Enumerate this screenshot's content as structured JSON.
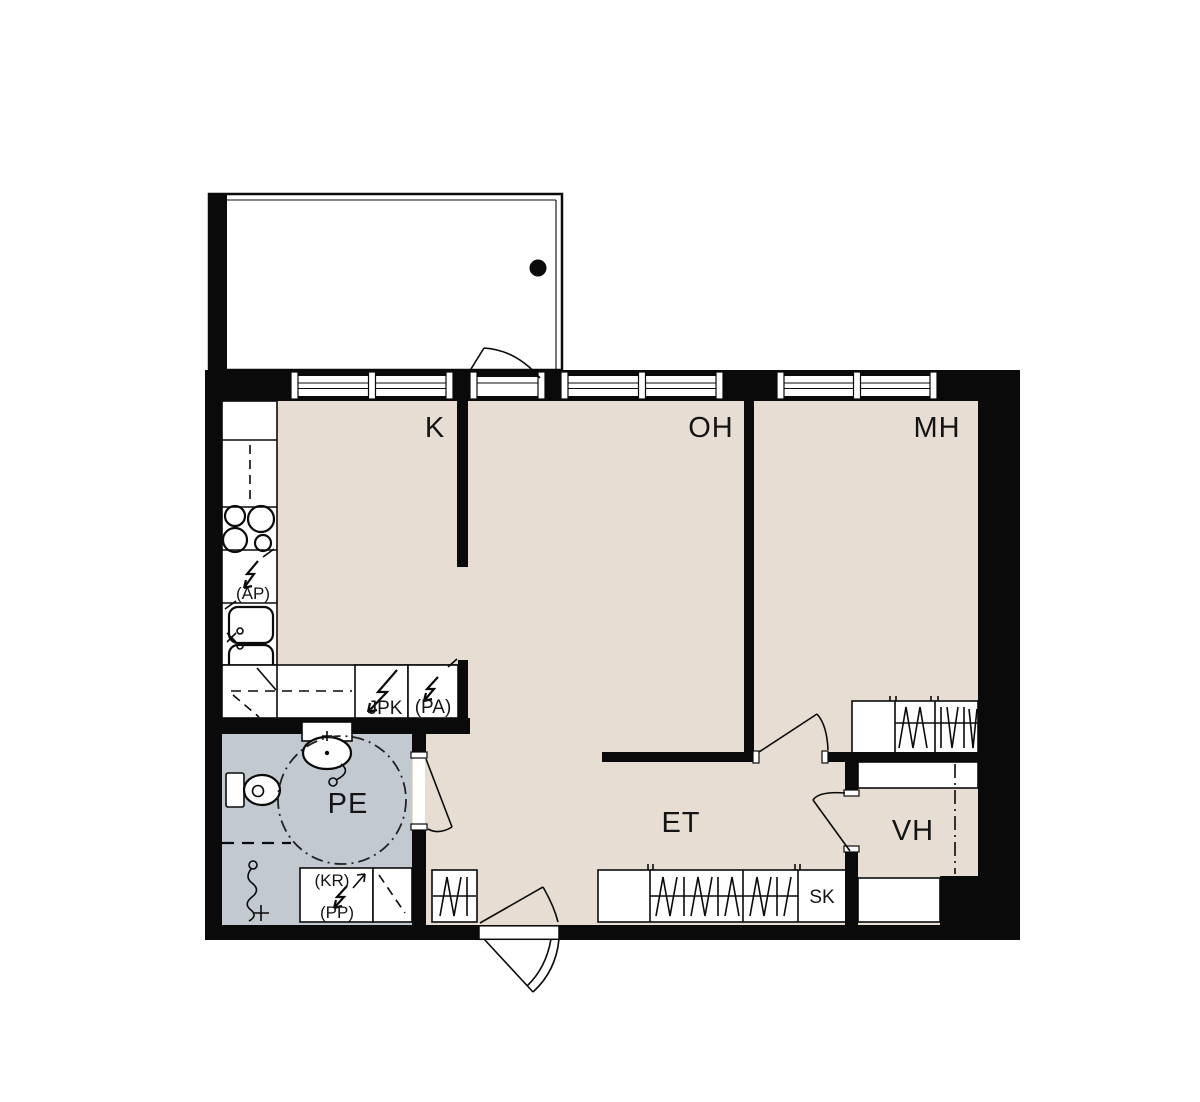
{
  "colors": {
    "bg": "#ffffff",
    "wall": "#0a0a0a",
    "floor": "#e7ddd2",
    "wet": "#c3c9d1",
    "ink": "#141414"
  },
  "rooms": {
    "kitchen": {
      "label": "K"
    },
    "living_room": {
      "label": "OH"
    },
    "bedroom": {
      "label": "MH"
    },
    "bathroom": {
      "label": "PE"
    },
    "entry_hall": {
      "label": "ET"
    },
    "walk_in_closet": {
      "label": "VH"
    },
    "cleaning_closet": {
      "label": "SK"
    }
  },
  "appliance_labels": {
    "fridge_freezer": {
      "label": "JPK"
    },
    "pa_reservation": {
      "label": "(PA)"
    },
    "ap_reservation": {
      "label": "(AP)"
    },
    "kr_reservation": {
      "label": "(KR)"
    },
    "pp_reservation": {
      "label": "(PP)"
    }
  }
}
